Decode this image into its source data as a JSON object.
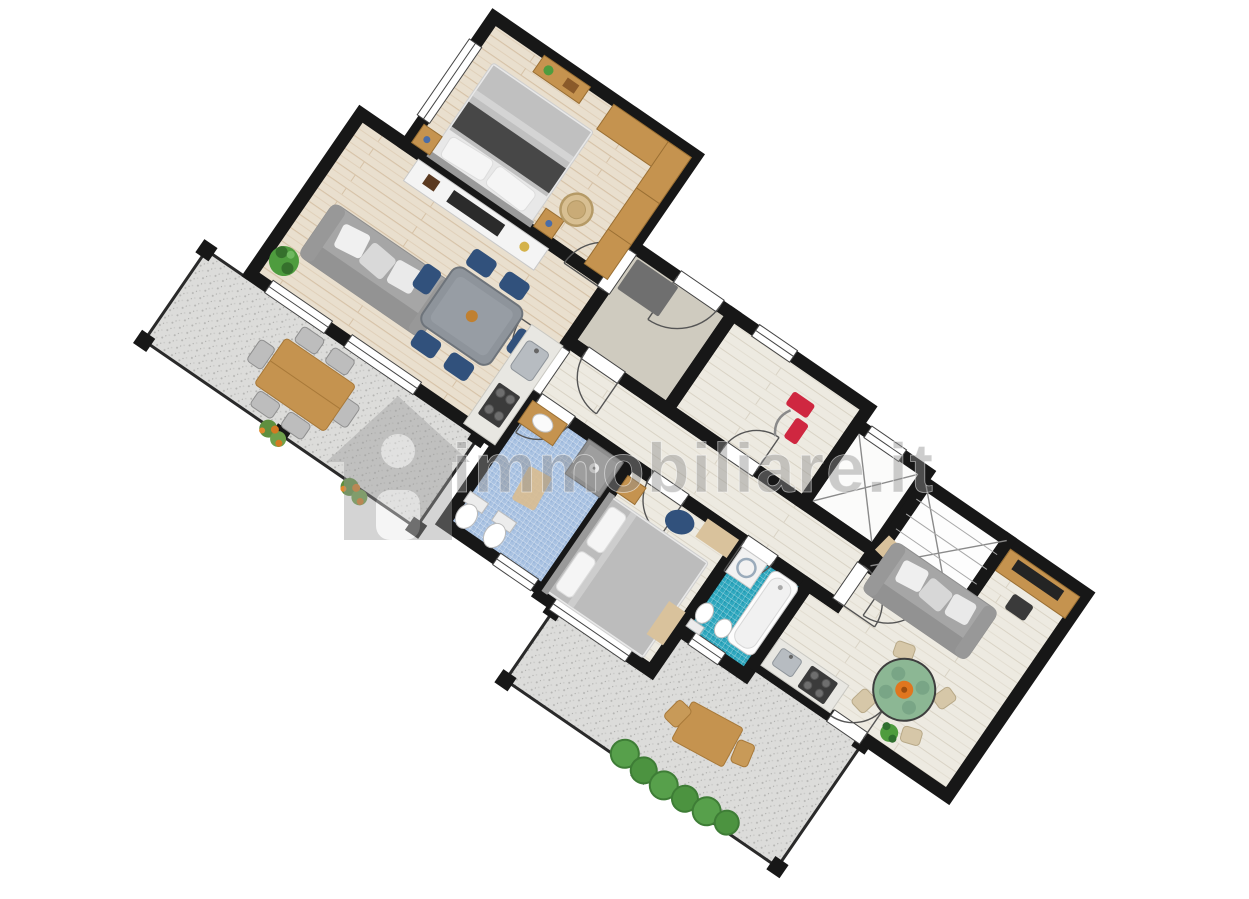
{
  "watermark": {
    "text": "immobiliare.it",
    "icon": "house-icon"
  },
  "colors": {
    "wall": "#171717",
    "hall_floor": "#cfcbbf",
    "doormat_gray": "#6f6f6f",
    "sofa_gray": "#a6a6a6",
    "chair_navy": "#31517c",
    "table_gray": "#8e949b",
    "furniture_wood": "#c5934f",
    "rug_green": "#8cb794",
    "rug_center_orange": "#e0761f",
    "appliance_red": "#cf2740",
    "plant_green": "#4e9c3e",
    "bath_blue": "#a9c2e2",
    "bath_teal": "#2fa8bf",
    "terrace_gray": "#dcdcda",
    "wood_warm": "#e9dfce",
    "wood_pale": "#edeae1",
    "watermark_gray": "#909090"
  }
}
